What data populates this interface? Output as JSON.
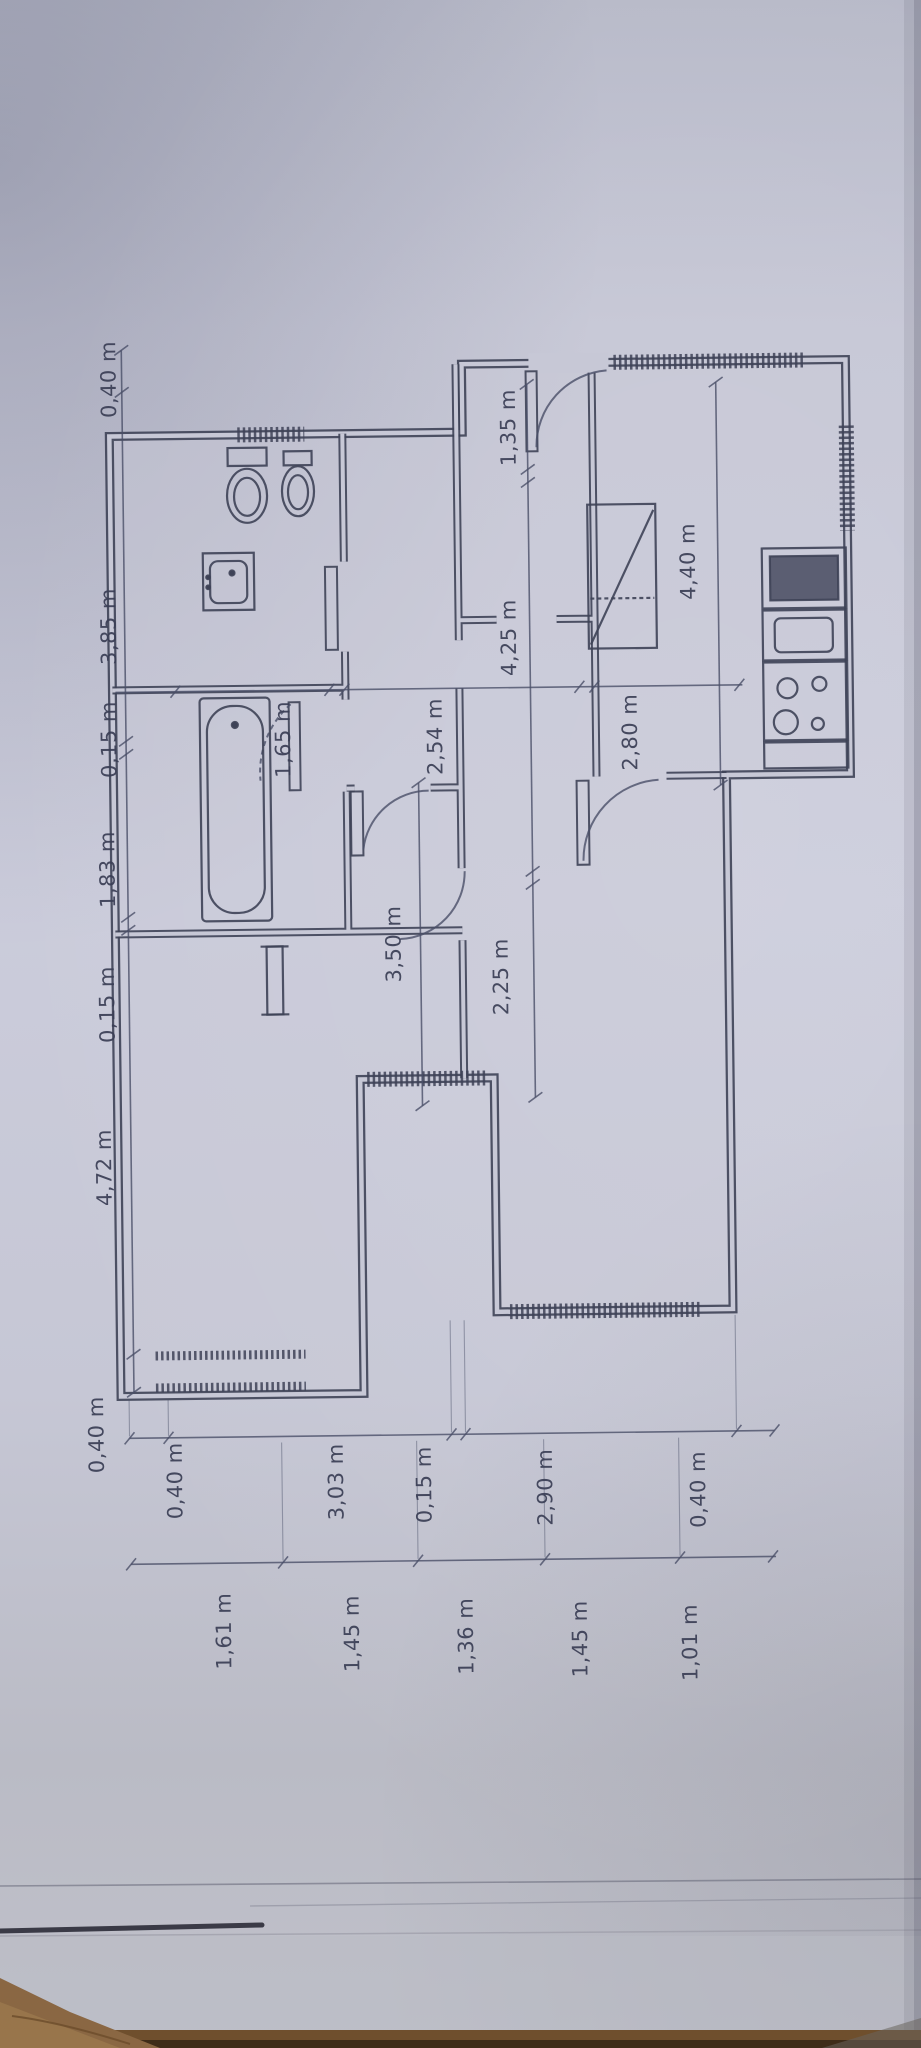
{
  "photo": {
    "subject": "hand-drafted apartment floor plan on paper, rotated 90 degrees",
    "unit": "m",
    "colors": {
      "paper": "#c6c7d6",
      "ink": "#3e4257",
      "wood": "#8a6743"
    }
  },
  "dimensions": {
    "side_chain": [
      "0,40 m",
      "3,85 m",
      "0,15 m",
      "1,83 m",
      "0,15 m",
      "4,72 m",
      "0,40 m"
    ],
    "end_chain_outer": [
      "0,40 m",
      "3,03 m",
      "0,15 m",
      "2,90 m",
      "0,40 m"
    ],
    "end_chain_inner": [
      "1,61 m",
      "1,45 m",
      "1,36 m",
      "1,45 m",
      "1,01 m"
    ],
    "interior": {
      "bathroom_width": "1,65 m",
      "room_width": "2,54 m",
      "hall_length": "4,25 m",
      "entry_width": "1,35 m",
      "kitchen_length": "4,40 m",
      "kitchen_width": "2,80 m",
      "corridor_length": "2,25 m",
      "bedroom_width": "3,50 m"
    }
  }
}
